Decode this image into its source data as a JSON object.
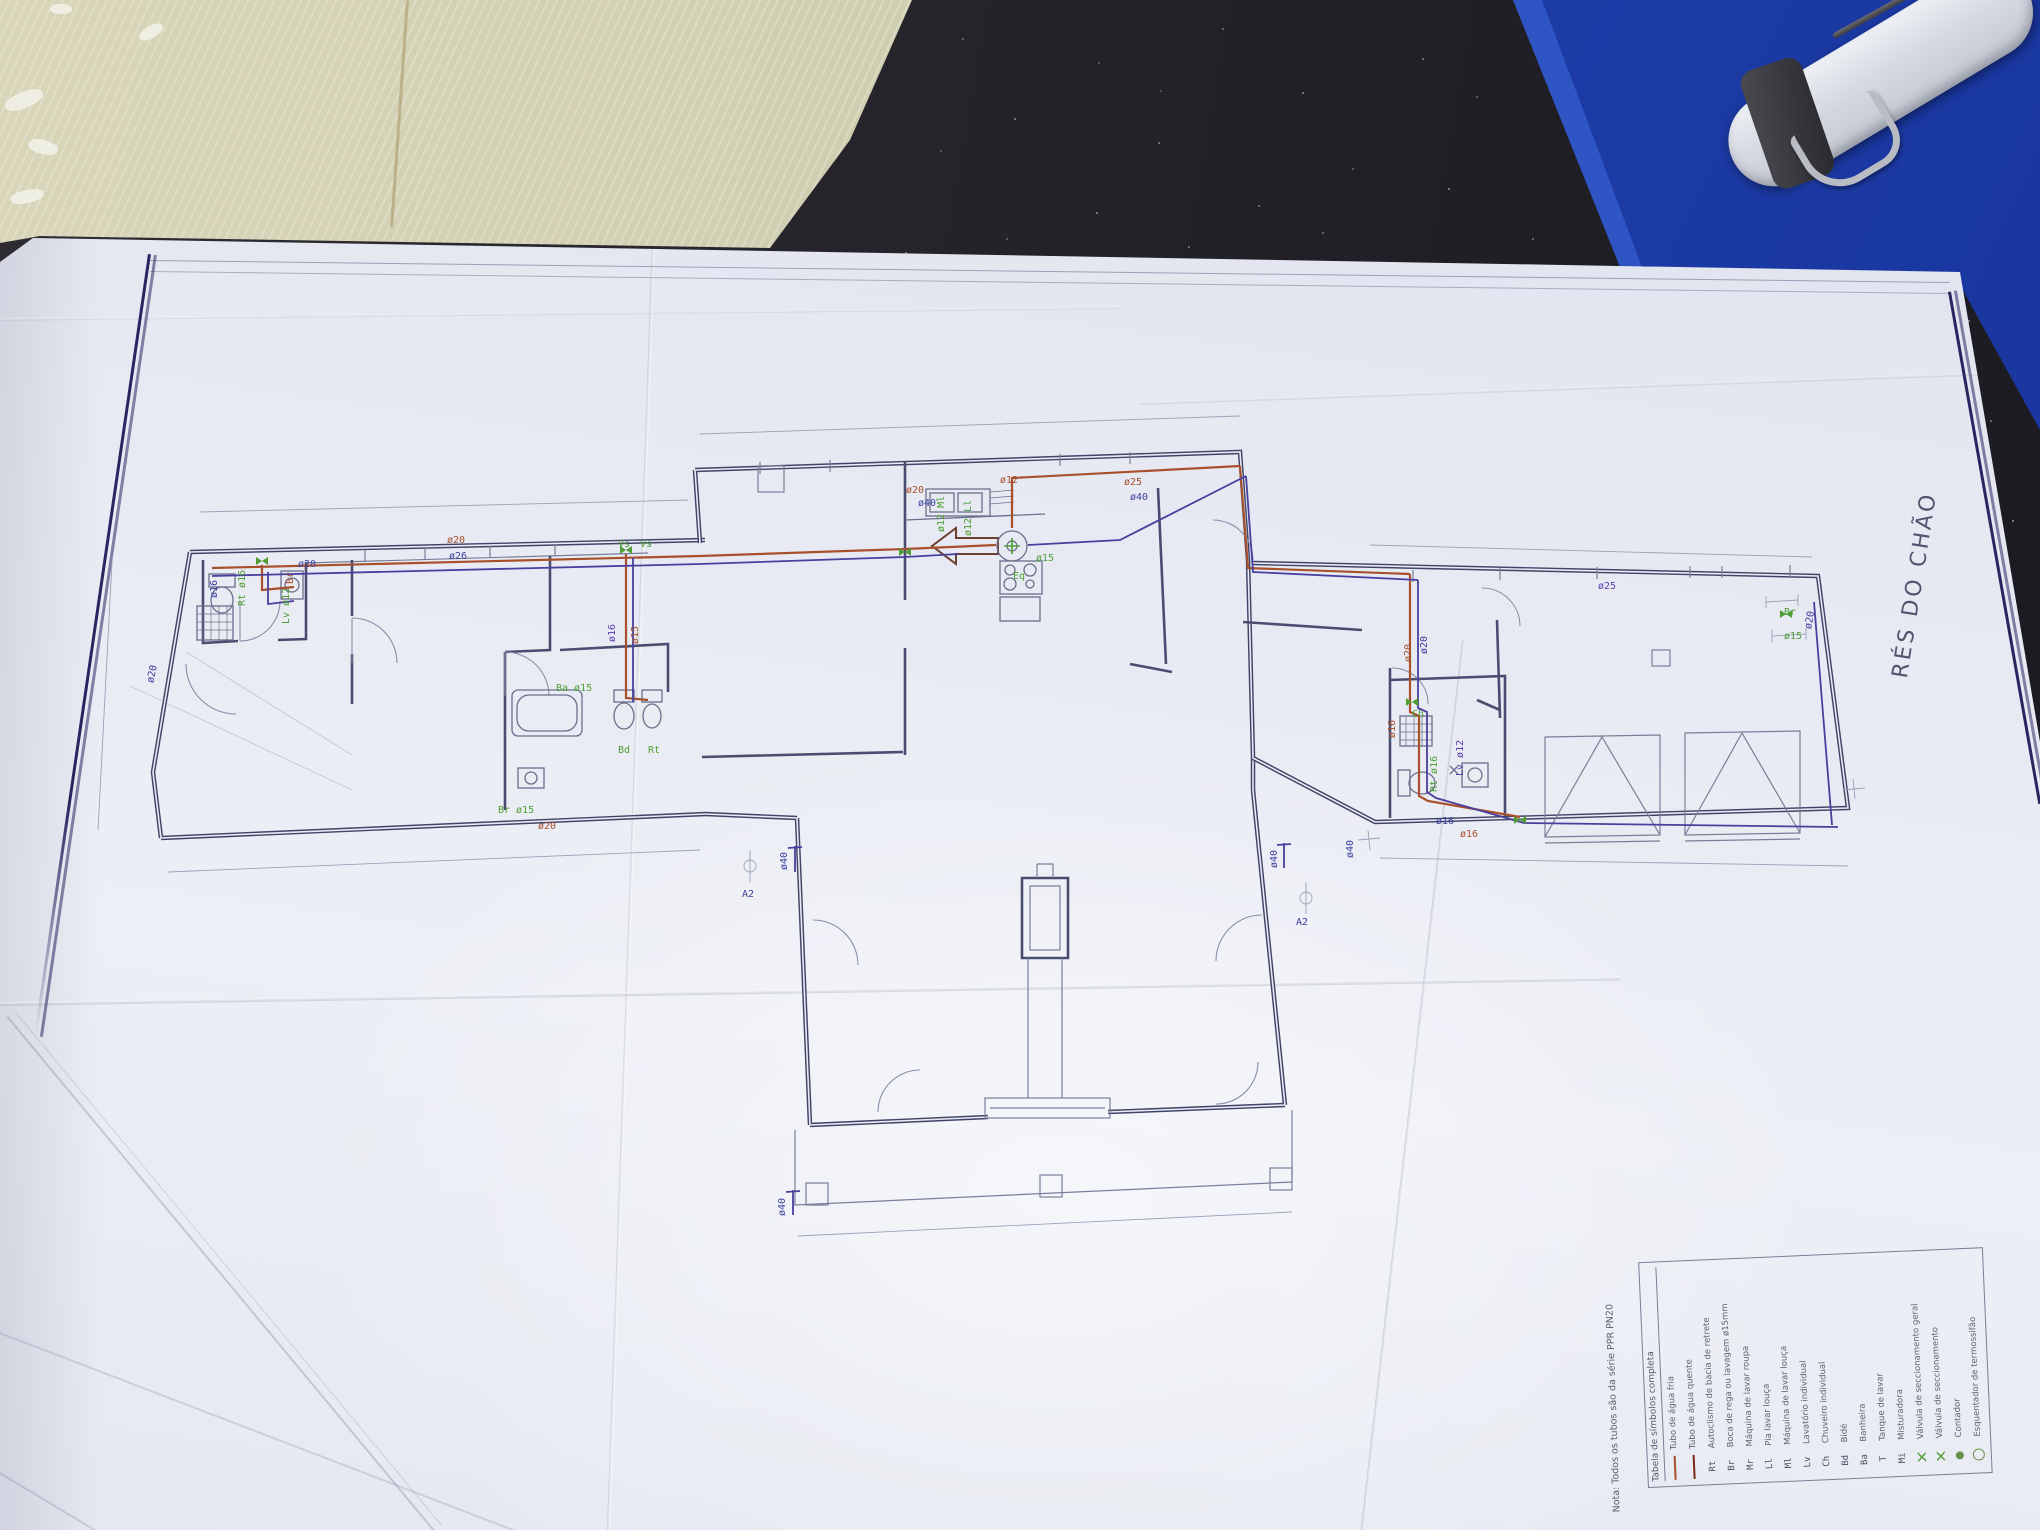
{
  "floor_label": "RÉS DO CHÃO",
  "legend": {
    "note": "Nota: Todos os tubos são da série PPR PN20",
    "title": "Tabela de símbolos completa",
    "rows": [
      {
        "sw": "red",
        "abbr": "",
        "label": "Tubo de água fria"
      },
      {
        "sw": "dred",
        "abbr": "",
        "label": "Tubo de água quente"
      },
      {
        "abbr": "Rt",
        "label": "Autoclismo de bacia de retrete"
      },
      {
        "abbr": "Br",
        "label": "Boca de rega ou lavagem ø15mm"
      },
      {
        "abbr": "Mr",
        "label": "Máquina de lavar roupa"
      },
      {
        "abbr": "Ll",
        "label": "Pia lavar louça"
      },
      {
        "abbr": "Ml",
        "label": "Máquina de lavar louça"
      },
      {
        "abbr": "Lv",
        "label": "Lavatório individual"
      },
      {
        "abbr": "Ch",
        "label": "Chuveiro individual"
      },
      {
        "abbr": "Bd",
        "label": "Bidé"
      },
      {
        "abbr": "Ba",
        "label": "Banheira"
      },
      {
        "abbr": "T",
        "label": "Tanque de lavar"
      },
      {
        "abbr": "Mi",
        "label": "Misturadora"
      },
      {
        "sw": "valve",
        "abbr": "",
        "label": "Válvula de seccionamento geral"
      },
      {
        "sw": "valve",
        "abbr": "",
        "label": "Válvula de seccionamento"
      },
      {
        "sw": "dot",
        "abbr": "",
        "label": "Contador"
      },
      {
        "sw": "circ",
        "abbr": "",
        "label": "Esquentador de termossifão"
      }
    ]
  },
  "pipe_labels": [
    {
      "t": "ø20",
      "c": "red",
      "x": 447,
      "y": 536,
      "r": 0
    },
    {
      "t": "ø26",
      "c": "blue",
      "x": 449,
      "y": 552,
      "r": 0
    },
    {
      "t": "Vs",
      "c": "green",
      "x": 618,
      "y": 540,
      "r": 0
    },
    {
      "t": "Vs",
      "c": "green",
      "x": 640,
      "y": 540,
      "r": 0
    },
    {
      "t": "ø20",
      "c": "blue",
      "x": 298,
      "y": 560,
      "r": 0
    },
    {
      "t": "ø16",
      "c": "blue",
      "x": 220,
      "y": 588,
      "r": -90
    },
    {
      "t": "Rt ø16",
      "c": "green",
      "x": 248,
      "y": 596,
      "r": -90
    },
    {
      "t": "Br",
      "c": "red",
      "x": 296,
      "y": 574,
      "r": -90
    },
    {
      "t": "ø20",
      "c": "blue",
      "x": 156,
      "y": 674,
      "r": -78
    },
    {
      "t": "Lv ø12",
      "c": "green",
      "x": 292,
      "y": 614,
      "r": -90
    },
    {
      "t": "ø16",
      "c": "purple",
      "x": 618,
      "y": 632,
      "r": -90
    },
    {
      "t": "ø15",
      "c": "red",
      "x": 641,
      "y": 634,
      "r": -90
    },
    {
      "t": "Ba ø15",
      "c": "green",
      "x": 556,
      "y": 684,
      "r": 0
    },
    {
      "t": "Bd",
      "c": "green",
      "x": 618,
      "y": 746,
      "r": 0
    },
    {
      "t": "Rt",
      "c": "green",
      "x": 648,
      "y": 746,
      "r": 0
    },
    {
      "t": "ø20",
      "c": "red",
      "x": 538,
      "y": 822,
      "r": 0
    },
    {
      "t": "Br ø15",
      "c": "green",
      "x": 498,
      "y": 806,
      "r": 0
    },
    {
      "t": "ø12",
      "c": "red",
      "x": 1000,
      "y": 476,
      "r": 0
    },
    {
      "t": "ø20",
      "c": "red",
      "x": 906,
      "y": 486,
      "r": 0
    },
    {
      "t": "ø40",
      "c": "blue",
      "x": 918,
      "y": 499,
      "r": 0
    },
    {
      "t": "ø25",
      "c": "red",
      "x": 1124,
      "y": 478,
      "r": 0
    },
    {
      "t": "ø40",
      "c": "blue",
      "x": 1130,
      "y": 493,
      "r": 0
    },
    {
      "t": "ø12 Ml",
      "c": "green",
      "x": 947,
      "y": 522,
      "r": -90
    },
    {
      "t": "ø12 Ll",
      "c": "green",
      "x": 974,
      "y": 526,
      "r": -90
    },
    {
      "t": "Eq",
      "c": "green",
      "x": 1013,
      "y": 572,
      "r": 0
    },
    {
      "t": "ø15",
      "c": "green",
      "x": 1036,
      "y": 554,
      "r": 0
    },
    {
      "t": "ø40",
      "c": "blue",
      "x": 790,
      "y": 860,
      "r": -90
    },
    {
      "t": "A2",
      "c": "blue",
      "x": 742,
      "y": 890,
      "r": 0
    },
    {
      "t": "ø40",
      "c": "blue",
      "x": 1280,
      "y": 858,
      "r": -90
    },
    {
      "t": "A2",
      "c": "blue",
      "x": 1296,
      "y": 918,
      "r": 0
    },
    {
      "t": "ø40",
      "c": "blue",
      "x": 788,
      "y": 1206,
      "r": -90
    },
    {
      "t": "ø25",
      "c": "purple",
      "x": 1598,
      "y": 582,
      "r": 0
    },
    {
      "t": "ø20",
      "c": "blue",
      "x": 1430,
      "y": 644,
      "r": -90
    },
    {
      "t": "ø20",
      "c": "red",
      "x": 1414,
      "y": 652,
      "r": -90
    },
    {
      "t": "ø16",
      "c": "red",
      "x": 1398,
      "y": 728,
      "r": -90
    },
    {
      "t": "Ch",
      "c": "green",
      "x": 1412,
      "y": 710,
      "r": 0
    },
    {
      "t": "Rt ø16",
      "c": "green",
      "x": 1440,
      "y": 782,
      "r": -90
    },
    {
      "t": "Lv ø12",
      "c": "purple",
      "x": 1466,
      "y": 766,
      "r": -90
    },
    {
      "t": "ø16",
      "c": "blue",
      "x": 1436,
      "y": 817,
      "r": 0
    },
    {
      "t": "ø16",
      "c": "red",
      "x": 1460,
      "y": 830,
      "r": 0
    },
    {
      "t": "Br",
      "c": "green",
      "x": 1784,
      "y": 608,
      "r": 0
    },
    {
      "t": "ø15",
      "c": "green",
      "x": 1784,
      "y": 632,
      "r": 0
    },
    {
      "t": "ø20",
      "c": "blue",
      "x": 1814,
      "y": 620,
      "r": -80
    },
    {
      "t": "ø40",
      "c": "blue",
      "x": 1356,
      "y": 848,
      "r": -90
    }
  ],
  "colors": {
    "pipe_cold": "#3a3f9e",
    "pipe_hot": "#a8502c",
    "fixture_green": "#4f9e35",
    "wall": "#3f4468",
    "border_navy": "#2a2560",
    "folder_blue": "#1d3da8"
  }
}
